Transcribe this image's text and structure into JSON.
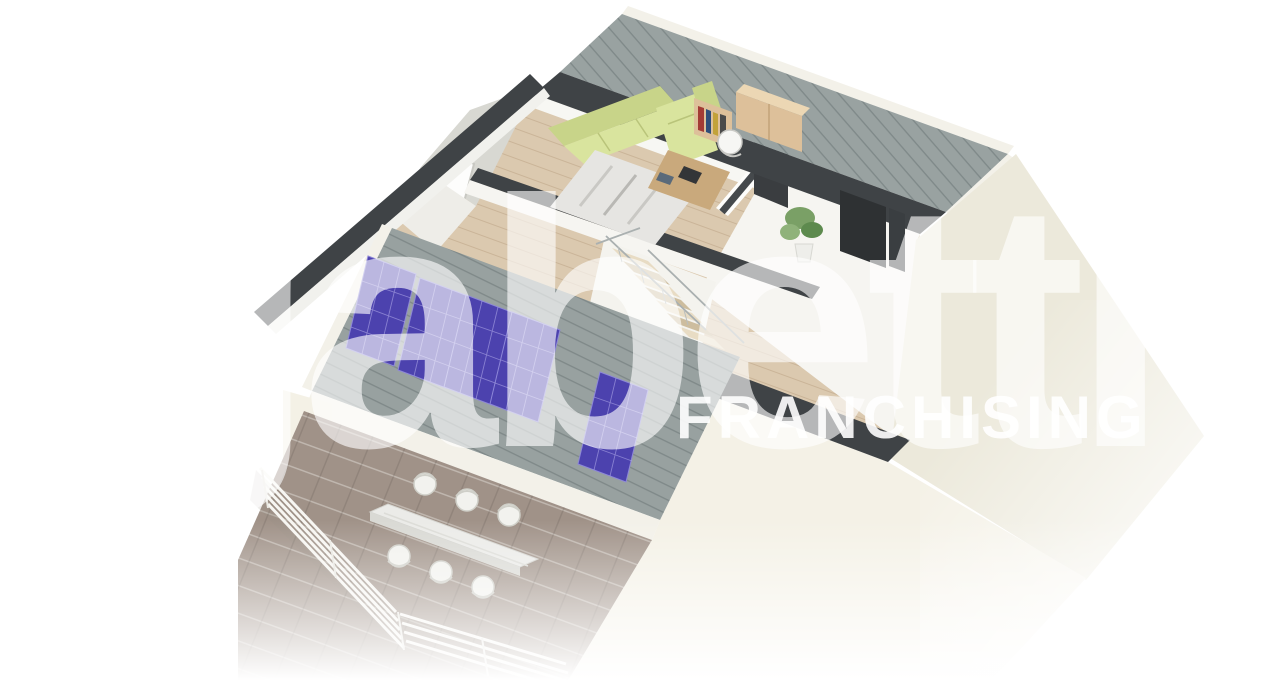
{
  "page": {
    "background_color": "#ffffff",
    "content_type": "3D isometric cutaway floor-plan render of an attic apartment (real-estate listing image)"
  },
  "watermark": {
    "brand_text": "gabetti",
    "subtitle_text": "FRANCHISING",
    "color": "#ffffff"
  },
  "scene": {
    "rooms": [
      {
        "name": "living room",
        "floor": "light wood planks",
        "furniture": [
          "corner sofa",
          "bookshelf with books",
          "wooden sideboard",
          "desk",
          "office chair",
          "rug"
        ]
      },
      {
        "name": "empty room",
        "floor": "white",
        "features": [
          "dark interior door",
          "potted plant"
        ]
      },
      {
        "name": "stair hall",
        "features": [
          "open staircase going down",
          "metal railing",
          "potted plant"
        ]
      },
      {
        "name": "terrace",
        "floor": "taupe tiles",
        "furniture": [
          "white dining table",
          "6 white chairs"
        ],
        "features": [
          "white slat railing"
        ]
      }
    ],
    "roof": {
      "material": "standing-seam metal",
      "solar_panel_count": 5
    },
    "left_gable": {
      "window_count": 1
    }
  },
  "colors": {
    "roof_metal": "#99a2a1",
    "roof_seam": "#7e8888",
    "wall_top_dark": "#3f4346",
    "exterior_wall_bright": "#f4f1e6",
    "exterior_wall_shaded": "#ece9db",
    "interior_wall": "#fbfbf9",
    "wood_floor": "#dbc9af",
    "empty_room_floor": "#f6f5f1",
    "terrace_tile": "#a09288",
    "solar_panel": "#4c42ae",
    "solar_panel_grid": "#8d87d8",
    "sofa_light": "#d9e49e",
    "sofa_dark": "#c8d489",
    "furniture_wood": "#ddc09a",
    "furniture_wood_top": "#ecd7b4",
    "desk_wood": "#c9a97c",
    "rug": "#e6e5e2",
    "plant_green": "#7aa066",
    "plant_green_dark": "#5d8a4e",
    "door_dark": "#2e3133",
    "railing_white": "#f7f6f2",
    "table_white": "#ebebe8",
    "gable_wall": "#d8d8d2",
    "fascia_white": "#f3f1e9"
  }
}
